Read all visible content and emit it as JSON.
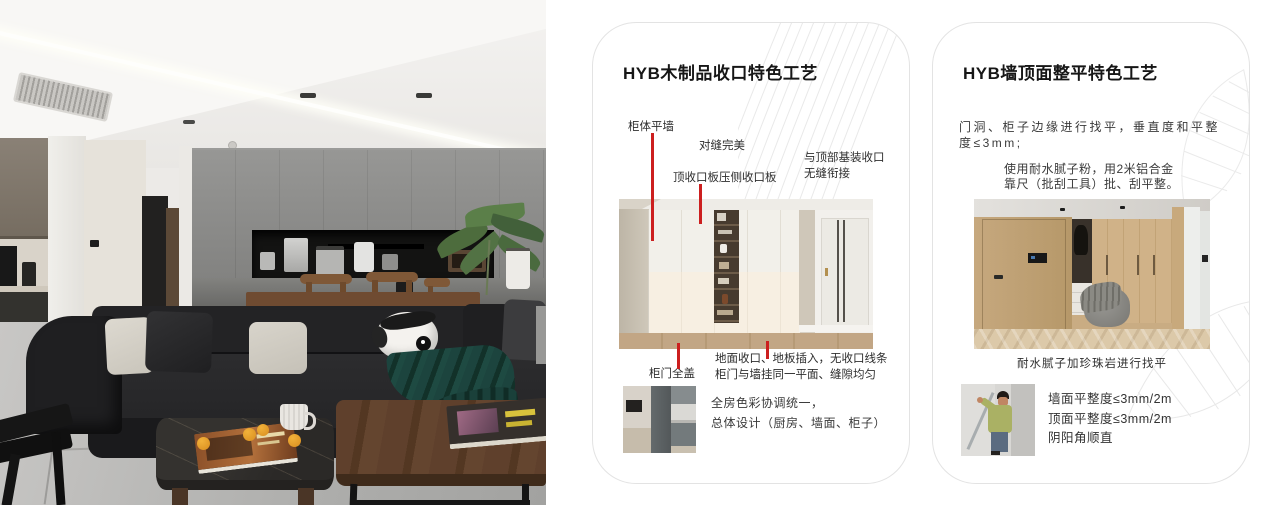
{
  "colors": {
    "accent_red": "#cc1f1f",
    "card_border": "#e3e3e3",
    "title_text": "#161616",
    "body_text": "#3a3a3a"
  },
  "card_wood": {
    "title": "HYB木制品收口特色工艺",
    "callout_cabinet_wall": "柜体平墙",
    "callout_seam": "对缝完美",
    "callout_top_board": "顶收口板压侧收口板",
    "callout_top_joint_line1": "与顶部基装收口",
    "callout_top_joint_line2": "无缝衔接",
    "callout_door_cover": "柜门全盖",
    "callout_floor_line1": "地面收口、地板插入，无收口线条",
    "callout_floor_line2": "柜门与墙挂同一平面、缝隙均匀",
    "note_line1": "全房色彩协调统一，",
    "note_line2": "总体设计（厨房、墙面、柜子）"
  },
  "card_wall": {
    "title": "HYB墙顶面整平特色工艺",
    "para1_line1": "门洞、柜子边缘进行找平，垂直度和平整",
    "para1_line2": "度≤3mm;",
    "para2_line1": "使用耐水腻子粉，用2米铝合金",
    "para2_line2": "靠尺（批刮工具）批、刮平整。",
    "caption": "耐水腻子加珍珠岩进行找平",
    "spec_line1": "墙面平整度≤3mm/2m",
    "spec_line2": "顶面平整度≤3mm/2m",
    "spec_line3": "阴阳角顺直"
  }
}
